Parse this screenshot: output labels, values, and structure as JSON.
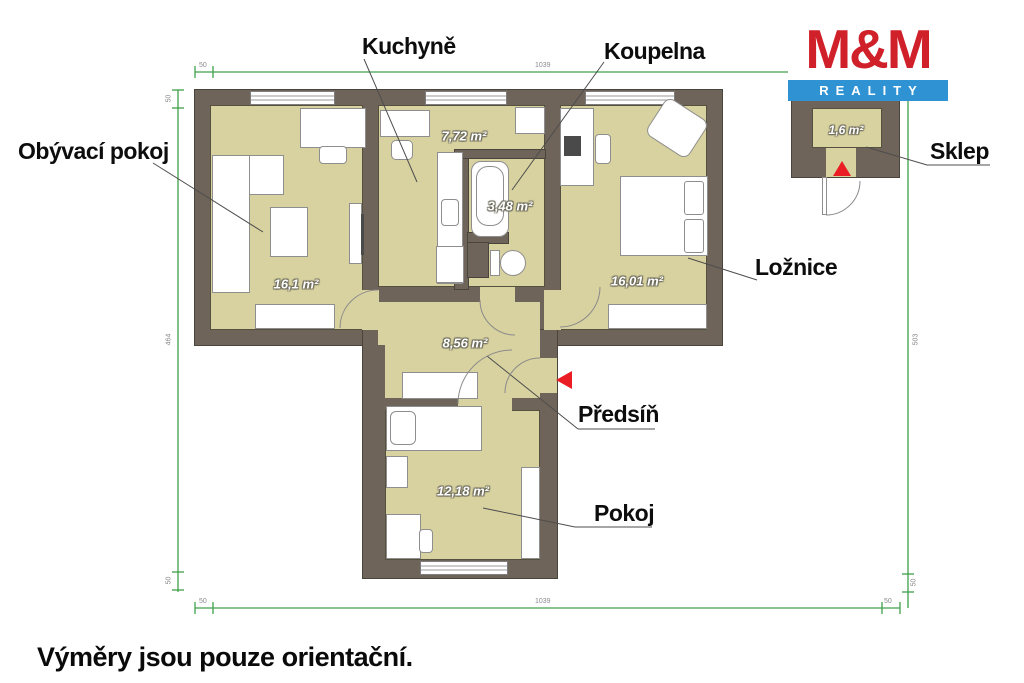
{
  "rooms": [
    {
      "name": "Obývací pokoj",
      "area": "16,1 m²"
    },
    {
      "name": "Kuchyně",
      "area": "7,72 m²"
    },
    {
      "name": "Koupelna",
      "area": "3,48 m²"
    },
    {
      "name": "Ložnice",
      "area": "16,01 m²"
    },
    {
      "name": "Předsíň",
      "area": "8,56 m²"
    },
    {
      "name": "Pokoj",
      "area": "12,18 m²"
    },
    {
      "name": "Sklep",
      "area": "1,6 m²"
    }
  ],
  "logo": {
    "title": "M&M",
    "subtitle": "REALITY"
  },
  "footer": "Výměry jsou pouze orientační.",
  "dimensions": {
    "top": [
      "50",
      "1039",
      "50"
    ],
    "bottom": [
      "50",
      "1039",
      "50"
    ],
    "left": [
      "50",
      "464",
      "50"
    ],
    "right": [
      "50",
      "503",
      "50"
    ]
  },
  "colors": {
    "wall": "#6f6459",
    "room_fill": "#d8d2a0",
    "dimension_green": "#3fa24a",
    "arrow_red": "#ea1c24",
    "logo_red": "#d0202a",
    "logo_blue": "#2f93d3"
  }
}
